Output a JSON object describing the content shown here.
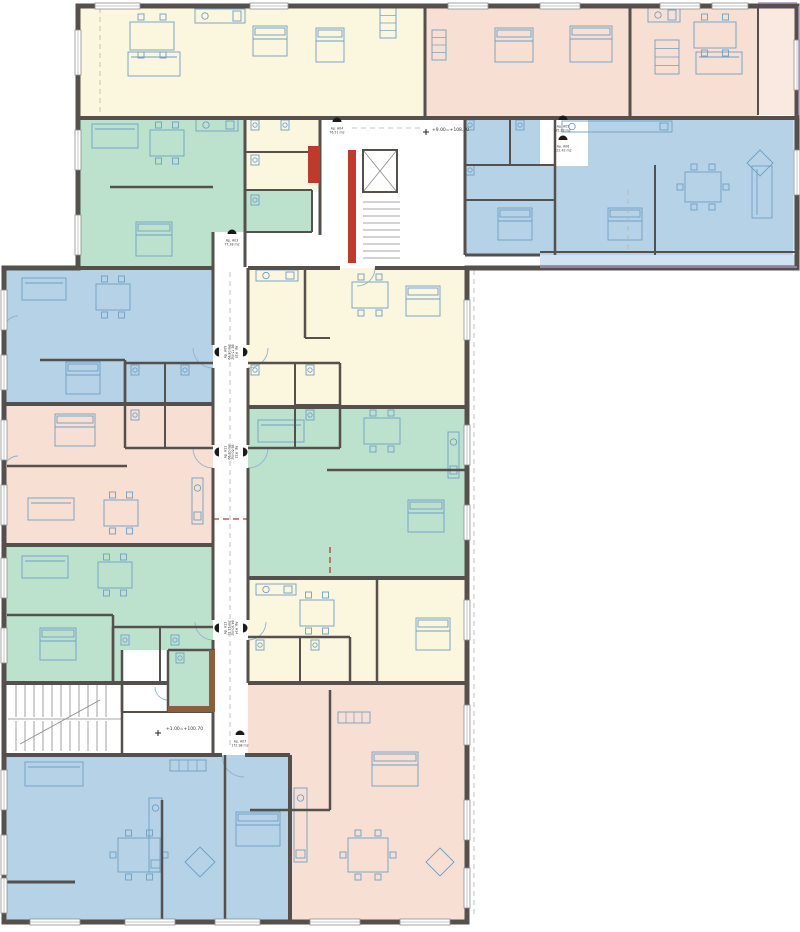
{
  "canvas": {
    "w": 800,
    "h": 932,
    "bg": "#ffffff"
  },
  "palette": {
    "cream": "#FBF6DE",
    "pink": "#F8DFD4",
    "pinkbal": "#FAE9E0",
    "green": "#BCE2CE",
    "blue": "#B5D2E6",
    "bluebal": "#CFE3F0",
    "wall": "#55504C",
    "red": "#C03A2B",
    "brown": "#8B5E3C",
    "furn": "#6F9FC4",
    "arc": "#8FB3CF",
    "thin": "#8A8A8A",
    "winframe": "#8F8F8F",
    "dash": "#B9B3AD",
    "reddash": "#C0392B",
    "rail": "#A98FC0",
    "text": "#3A3A3A",
    "marker": "#1A1A1A"
  },
  "labels": [
    {
      "t": "+9.00=+108.70",
      "x": 432,
      "y": 131
    },
    {
      "t": "+1.00=+100.70",
      "x": 166,
      "y": 730
    }
  ],
  "markers": [
    {
      "x": 232,
      "y": 234,
      "r": 0,
      "l1": "Ap. A03",
      "l2": "77.38 m2"
    },
    {
      "x": 337,
      "y": 122,
      "r": 0,
      "l1": "Ap. A04",
      "l2": "76.51 m2"
    },
    {
      "x": 563,
      "y": 120,
      "r": 0,
      "l1": "Ap. A05",
      "l2": "95.28 m2"
    },
    {
      "x": 563,
      "y": 140,
      "r": 0,
      "l1": "Ap. A06",
      "l2": "122.42 m2"
    },
    {
      "x": 219,
      "y": 352,
      "r": -90,
      "l1": "Ap. A09",
      "l2": "64.30 m2"
    },
    {
      "x": 243,
      "y": 352,
      "r": 90,
      "l1": "Ap. A10",
      "l2": "88.75 m2"
    },
    {
      "x": 219,
      "y": 452,
      "r": -90,
      "l1": "Ap. A11",
      "l2": "66.20 m2"
    },
    {
      "x": 243,
      "y": 452,
      "r": 90,
      "l1": "Ap. A12",
      "l2": "98.60 m2"
    },
    {
      "x": 219,
      "y": 628,
      "r": -90,
      "l1": "Ap. A13",
      "l2": "72.15 m2"
    },
    {
      "x": 243,
      "y": 628,
      "r": 90,
      "l1": "Ap. A14",
      "l2": "84.90 m2"
    },
    {
      "x": 240,
      "y": 735,
      "r": 0,
      "l1": "Ap. A07",
      "l2": "172.98 m2"
    }
  ],
  "fills": [
    {
      "n": "unit-cream-top-left",
      "c": "cream",
      "p": "78,6 425,6 425,118 78,118"
    },
    {
      "n": "unit-pink-top-center",
      "c": "pink",
      "p": "425,6 630,6 630,118 425,118"
    },
    {
      "n": "unit-pink-top-right",
      "c": "pink",
      "p": "630,6 758,6 758,118 630,118"
    },
    {
      "n": "balcony-pink-right",
      "c": "pinkbal",
      "p": "758,6 797,6 797,115 758,115"
    },
    {
      "n": "unit-blue-top-right",
      "c": "blue",
      "p": "465,118 793,118 793,255 465,255"
    },
    {
      "n": "balcony-blue-right",
      "c": "bluebal",
      "p": "793,118 800,118 800,250 793,250"
    },
    {
      "n": "balcony-blue-bottom",
      "c": "bluebal",
      "p": "540,255 797,255 797,268 540,268"
    },
    {
      "n": "unit-green-top-left",
      "c": "green",
      "p": "78,118 245,118 245,267 78,267"
    },
    {
      "n": "room-green-small",
      "c": "green",
      "p": "245,190 312,190 312,232 245,232"
    },
    {
      "n": "rooms-cream-bath",
      "c": "cream",
      "p": "245,118 320,118 320,190 245,190"
    },
    {
      "n": "unit-blue-wing-top",
      "c": "blue",
      "p": "4,268 213,268 213,404 4,404"
    },
    {
      "n": "unit-pink-wing",
      "c": "pink",
      "p": "4,404 213,404 213,545 4,545"
    },
    {
      "n": "unit-green-wing-left",
      "c": "green",
      "p": "4,545 213,545 213,683 4,683"
    },
    {
      "n": "unit-yellow-wing-top",
      "c": "cream",
      "p": "248,268 467,268 467,407 248,407"
    },
    {
      "n": "unit-green-wing-right",
      "c": "green",
      "p": "248,407 467,407 467,578 248,578"
    },
    {
      "n": "unit-yellow-wing-bot",
      "c": "cream",
      "p": "248,578 467,578 467,683 248,683"
    },
    {
      "n": "unit-blue-wing-bottom",
      "c": "blue",
      "p": "4,755 290,755 290,922 4,922"
    },
    {
      "n": "unit-pink-wing-bottom",
      "c": "pink",
      "p": "248,683 467,683 467,922 290,922 290,755 248,755"
    },
    {
      "n": "room-green-bath",
      "c": "green",
      "p": "168,650 215,650 215,712 168,712"
    }
  ],
  "whites": [
    {
      "n": "corridor-patch",
      "p": "213,232 245,232 245,268 213,268"
    },
    {
      "n": "stair-vestibule",
      "p": "122,650 168,650 168,712 122,712"
    },
    {
      "n": "entry-lobby-top",
      "p": "540,118 588,118 588,166 540,166"
    }
  ],
  "outline": "M78,6 H797 V268 H467 V922 H4 V268 H78 Z",
  "walls": [
    [
      425,
      6,
      425,
      118,
      3
    ],
    [
      630,
      6,
      630,
      118,
      3
    ],
    [
      758,
      6,
      758,
      115,
      2
    ],
    [
      78,
      118,
      797,
      118,
      4
    ],
    [
      465,
      118,
      465,
      255,
      3
    ],
    [
      320,
      118,
      320,
      235,
      3
    ],
    [
      245,
      118,
      245,
      267,
      3
    ],
    [
      245,
      152,
      320,
      152,
      2
    ],
    [
      245,
      190,
      312,
      190,
      2
    ],
    [
      245,
      232,
      312,
      232,
      2
    ],
    [
      312,
      190,
      312,
      232,
      2
    ],
    [
      110,
      187,
      213,
      187,
      2.5
    ],
    [
      213,
      232,
      213,
      268,
      3
    ],
    [
      555,
      118,
      555,
      255,
      2.5
    ],
    [
      465,
      165,
      555,
      165,
      2
    ],
    [
      510,
      118,
      510,
      165,
      2
    ],
    [
      465,
      200,
      555,
      200,
      2
    ],
    [
      655,
      165,
      655,
      255,
      2
    ],
    [
      465,
      255,
      540,
      255,
      3
    ],
    [
      540,
      252,
      797,
      252,
      2
    ],
    [
      78,
      268,
      213,
      268,
      4
    ],
    [
      248,
      268,
      340,
      268,
      4
    ],
    [
      375,
      268,
      467,
      268,
      4
    ],
    [
      4,
      404,
      213,
      404,
      4
    ],
    [
      4,
      545,
      213,
      545,
      4
    ],
    [
      4,
      683,
      168,
      683,
      4
    ],
    [
      4,
      755,
      222,
      755,
      4
    ],
    [
      245,
      755,
      290,
      755,
      4
    ],
    [
      290,
      755,
      290,
      922,
      4
    ],
    [
      248,
      407,
      467,
      407,
      4
    ],
    [
      248,
      578,
      467,
      578,
      4
    ],
    [
      248,
      683,
      467,
      683,
      4
    ],
    [
      213,
      268,
      213,
      345,
      3
    ],
    [
      213,
      368,
      213,
      445,
      3
    ],
    [
      213,
      468,
      213,
      620,
      3
    ],
    [
      213,
      640,
      213,
      755,
      3
    ],
    [
      248,
      268,
      248,
      345,
      3
    ],
    [
      248,
      368,
      248,
      445,
      3
    ],
    [
      248,
      468,
      248,
      620,
      3
    ],
    [
      248,
      640,
      248,
      683,
      3
    ],
    [
      125,
      363,
      213,
      363,
      2.5
    ],
    [
      125,
      448,
      213,
      448,
      2.5
    ],
    [
      125,
      363,
      125,
      448,
      2.5
    ],
    [
      165,
      363,
      165,
      448,
      2
    ],
    [
      125,
      405,
      165,
      405,
      2
    ],
    [
      248,
      363,
      340,
      363,
      2.5
    ],
    [
      248,
      448,
      340,
      448,
      2.5
    ],
    [
      340,
      363,
      340,
      448,
      2.5
    ],
    [
      295,
      363,
      295,
      448,
      2
    ],
    [
      295,
      405,
      340,
      405,
      2
    ],
    [
      113,
      627,
      213,
      627,
      2.5
    ],
    [
      113,
      627,
      113,
      683,
      2.5
    ],
    [
      160,
      627,
      160,
      683,
      2
    ],
    [
      248,
      637,
      350,
      637,
      2.5
    ],
    [
      350,
      637,
      350,
      683,
      2.5
    ],
    [
      300,
      637,
      300,
      683,
      2
    ],
    [
      168,
      650,
      215,
      650,
      2.5
    ],
    [
      168,
      650,
      168,
      712,
      2.5
    ],
    [
      122,
      650,
      122,
      712,
      2.5
    ],
    [
      122,
      712,
      213,
      712,
      2
    ],
    [
      122,
      683,
      122,
      755,
      2.5
    ],
    [
      40,
      360,
      125,
      360,
      2.5
    ],
    [
      125,
      360,
      125,
      404,
      2.5
    ],
    [
      7,
      466,
      127,
      466,
      2.5
    ],
    [
      7,
      615,
      113,
      615,
      2.5
    ],
    [
      113,
      615,
      113,
      683,
      2.5
    ],
    [
      305,
      268,
      305,
      338,
      2.5
    ],
    [
      305,
      338,
      330,
      338,
      2
    ],
    [
      327,
      470,
      467,
      470,
      2.5
    ],
    [
      377,
      578,
      377,
      683,
      2.5
    ],
    [
      330,
      690,
      330,
      810,
      2.5
    ],
    [
      250,
      810,
      330,
      810,
      2.5
    ],
    [
      162,
      800,
      162,
      922,
      2.5
    ],
    [
      225,
      755,
      225,
      922,
      2.5
    ],
    [
      7,
      882,
      75,
      882,
      3
    ]
  ],
  "redwalls": [
    [
      348,
      150,
      8,
      113
    ],
    [
      308,
      146,
      12,
      37
    ]
  ],
  "brownwalls": [
    [
      168,
      706,
      47,
      6
    ],
    [
      209,
      650,
      6,
      62
    ]
  ],
  "windows": [
    [
      95,
      3,
      45,
      6
    ],
    [
      250,
      3,
      38,
      6
    ],
    [
      448,
      3,
      40,
      6
    ],
    [
      540,
      3,
      40,
      6
    ],
    [
      660,
      3,
      40,
      6
    ],
    [
      712,
      3,
      36,
      6
    ],
    [
      794,
      40,
      6,
      50
    ],
    [
      794,
      150,
      6,
      45
    ],
    [
      75,
      30,
      6,
      45
    ],
    [
      75,
      130,
      6,
      40
    ],
    [
      75,
      215,
      6,
      40
    ],
    [
      1,
      290,
      6,
      40
    ],
    [
      1,
      355,
      6,
      35
    ],
    [
      1,
      420,
      6,
      40
    ],
    [
      1,
      485,
      6,
      40
    ],
    [
      1,
      558,
      6,
      40
    ],
    [
      1,
      628,
      6,
      35
    ],
    [
      1,
      770,
      6,
      40
    ],
    [
      1,
      835,
      6,
      40
    ],
    [
      1,
      878,
      6,
      35
    ],
    [
      30,
      919,
      50,
      6
    ],
    [
      125,
      919,
      50,
      6
    ],
    [
      215,
      919,
      45,
      6
    ],
    [
      310,
      919,
      50,
      6
    ],
    [
      400,
      919,
      50,
      6
    ],
    [
      464,
      300,
      6,
      40
    ],
    [
      464,
      425,
      6,
      40
    ],
    [
      464,
      505,
      6,
      35
    ],
    [
      464,
      600,
      6,
      40
    ],
    [
      464,
      705,
      6,
      40
    ],
    [
      464,
      800,
      6,
      40
    ],
    [
      464,
      868,
      6,
      40
    ]
  ],
  "thin": [
    [
      363,
      202,
      400,
      202
    ],
    [
      363,
      209,
      400,
      209
    ],
    [
      363,
      216,
      400,
      216
    ],
    [
      363,
      223,
      400,
      223
    ],
    [
      363,
      230,
      400,
      230
    ],
    [
      363,
      237,
      400,
      237
    ],
    [
      363,
      244,
      400,
      244
    ],
    [
      363,
      251,
      400,
      251
    ],
    [
      363,
      258,
      400,
      258
    ],
    [
      363,
      150,
      397,
      192
    ],
    [
      397,
      150,
      363,
      192
    ],
    [
      16,
      685,
      16,
      717
    ],
    [
      25,
      685,
      25,
      717
    ],
    [
      34,
      685,
      34,
      717
    ],
    [
      43,
      685,
      43,
      717
    ],
    [
      52,
      685,
      52,
      717
    ],
    [
      61,
      685,
      61,
      717
    ],
    [
      70,
      685,
      70,
      717
    ],
    [
      79,
      685,
      79,
      717
    ],
    [
      88,
      685,
      88,
      717
    ],
    [
      97,
      685,
      97,
      717
    ],
    [
      106,
      685,
      106,
      717
    ],
    [
      16,
      721,
      16,
      751
    ],
    [
      25,
      721,
      25,
      751
    ],
    [
      34,
      721,
      34,
      751
    ],
    [
      43,
      721,
      43,
      751
    ],
    [
      52,
      721,
      52,
      751
    ],
    [
      61,
      721,
      61,
      751
    ],
    [
      70,
      721,
      70,
      751
    ],
    [
      79,
      721,
      79,
      751
    ],
    [
      88,
      721,
      88,
      751
    ],
    [
      97,
      721,
      97,
      751
    ],
    [
      106,
      721,
      106,
      751
    ],
    [
      8,
      719,
      122,
      719
    ],
    [
      20,
      744,
      100,
      700
    ]
  ],
  "elevator": [
    363,
    150,
    34,
    42
  ],
  "dashes": [
    [
      230,
      272,
      230,
      748
    ],
    [
      474,
      270,
      474,
      918
    ],
    [
      352,
      128,
      420,
      128
    ],
    [
      628,
      190,
      628,
      250
    ],
    [
      100,
      8,
      100,
      116
    ]
  ],
  "reddashes": [
    [
      213,
      519,
      248,
      519
    ],
    [
      330,
      547,
      330,
      578
    ]
  ],
  "rails": [
    [
      758,
      3,
      797,
      3
    ],
    [
      799,
      6,
      799,
      115
    ],
    [
      540,
      267,
      797,
      267
    ]
  ],
  "cross": [
    [
      423,
      132,
      429,
      132
    ],
    [
      426,
      129,
      426,
      135
    ],
    [
      155,
      733,
      161,
      733
    ],
    [
      158,
      730,
      158,
      736
    ]
  ],
  "arcs": [
    "M375,268 A18,18 0 0 1 357,286",
    "M213,368 A20,20 0 0 1 193,348",
    "M248,368 A20,20 0 0 0 268,348",
    "M213,468 A20,20 0 0 1 193,448",
    "M248,468 A20,20 0 0 0 268,448",
    "M213,640 A18,18 0 0 1 195,622",
    "M248,640 A18,18 0 0 0 266,622",
    "M222,755 A22,22 0 0 0 244,777",
    "M4,330 A14,14 0 0 1 18,316",
    "M4,470 A14,14 0 0 1 18,456",
    "M168,700 A13,13 0 0 1 155,687"
  ],
  "furniture": [
    [
      "table",
      130,
      22,
      44,
      28
    ],
    [
      "sofa",
      128,
      52,
      52,
      24
    ],
    [
      "kitchen",
      195,
      9,
      50,
      14
    ],
    [
      "bed",
      253,
      26,
      34,
      30
    ],
    [
      "bed",
      316,
      28,
      28,
      34
    ],
    [
      "ward",
      380,
      8,
      16,
      30
    ],
    [
      "bed",
      495,
      28,
      38,
      34
    ],
    [
      "bed",
      570,
      26,
      42,
      36
    ],
    [
      "ward",
      432,
      30,
      14,
      30
    ],
    [
      "kitchen",
      648,
      8,
      32,
      14
    ],
    [
      "table",
      694,
      22,
      42,
      26
    ],
    [
      "sofa",
      696,
      52,
      46,
      22
    ],
    [
      "ward",
      655,
      40,
      24,
      34
    ],
    [
      "kitchen",
      562,
      121,
      110,
      11
    ],
    [
      "table",
      685,
      172,
      36,
      30
    ],
    [
      "sofa",
      752,
      166,
      20,
      52
    ],
    [
      "rug",
      747,
      150,
      26,
      26
    ],
    [
      "bed",
      498,
      208,
      34,
      32
    ],
    [
      "bed",
      608,
      208,
      34,
      32
    ],
    [
      "sofa",
      92,
      124,
      46,
      24
    ],
    [
      "table",
      150,
      130,
      34,
      26
    ],
    [
      "kitchen",
      196,
      119,
      42,
      12
    ],
    [
      "bed",
      136,
      222,
      36,
      34
    ],
    [
      "sofa",
      22,
      278,
      44,
      22
    ],
    [
      "table",
      96,
      284,
      34,
      26
    ],
    [
      "bed",
      66,
      362,
      34,
      32
    ],
    [
      "kitchen",
      256,
      270,
      42,
      11
    ],
    [
      "table",
      352,
      282,
      36,
      26
    ],
    [
      "bed",
      406,
      286,
      34,
      30
    ],
    [
      "bed",
      55,
      414,
      40,
      32
    ],
    [
      "sofa",
      28,
      498,
      46,
      22
    ],
    [
      "table",
      104,
      500,
      34,
      26
    ],
    [
      "kitchen",
      192,
      478,
      11,
      46
    ],
    [
      "sofa",
      258,
      420,
      46,
      22
    ],
    [
      "table",
      364,
      418,
      36,
      26
    ],
    [
      "kitchen",
      448,
      432,
      11,
      46
    ],
    [
      "bed",
      408,
      500,
      36,
      32
    ],
    [
      "sofa",
      22,
      556,
      46,
      22
    ],
    [
      "table",
      98,
      562,
      34,
      26
    ],
    [
      "bed",
      40,
      628,
      36,
      32
    ],
    [
      "kitchen",
      256,
      584,
      40,
      11
    ],
    [
      "table",
      300,
      600,
      34,
      26
    ],
    [
      "bed",
      416,
      618,
      34,
      32
    ],
    [
      "sofa",
      25,
      762,
      58,
      24
    ],
    [
      "rug",
      185,
      847,
      30,
      30
    ],
    [
      "table",
      118,
      838,
      42,
      34
    ],
    [
      "kitchen",
      149,
      798,
      13,
      74
    ],
    [
      "bed",
      236,
      812,
      44,
      34
    ],
    [
      "ward",
      170,
      760,
      36,
      11
    ],
    [
      "bed",
      372,
      752,
      46,
      34
    ],
    [
      "table",
      348,
      838,
      40,
      34
    ],
    [
      "rug",
      426,
      848,
      28,
      28
    ],
    [
      "kitchen",
      294,
      788,
      13,
      74
    ],
    [
      "ward",
      338,
      712,
      32,
      11
    ]
  ],
  "fixtures": [
    [
      135,
      370
    ],
    [
      185,
      370
    ],
    [
      135,
      415
    ],
    [
      255,
      370
    ],
    [
      310,
      370
    ],
    [
      310,
      415
    ],
    [
      125,
      640
    ],
    [
      175,
      640
    ],
    [
      260,
      645
    ],
    [
      315,
      645
    ],
    [
      255,
      125
    ],
    [
      285,
      125
    ],
    [
      255,
      160
    ],
    [
      470,
      125
    ],
    [
      520,
      125
    ],
    [
      470,
      170
    ],
    [
      180,
      658
    ],
    [
      255,
      200
    ]
  ]
}
